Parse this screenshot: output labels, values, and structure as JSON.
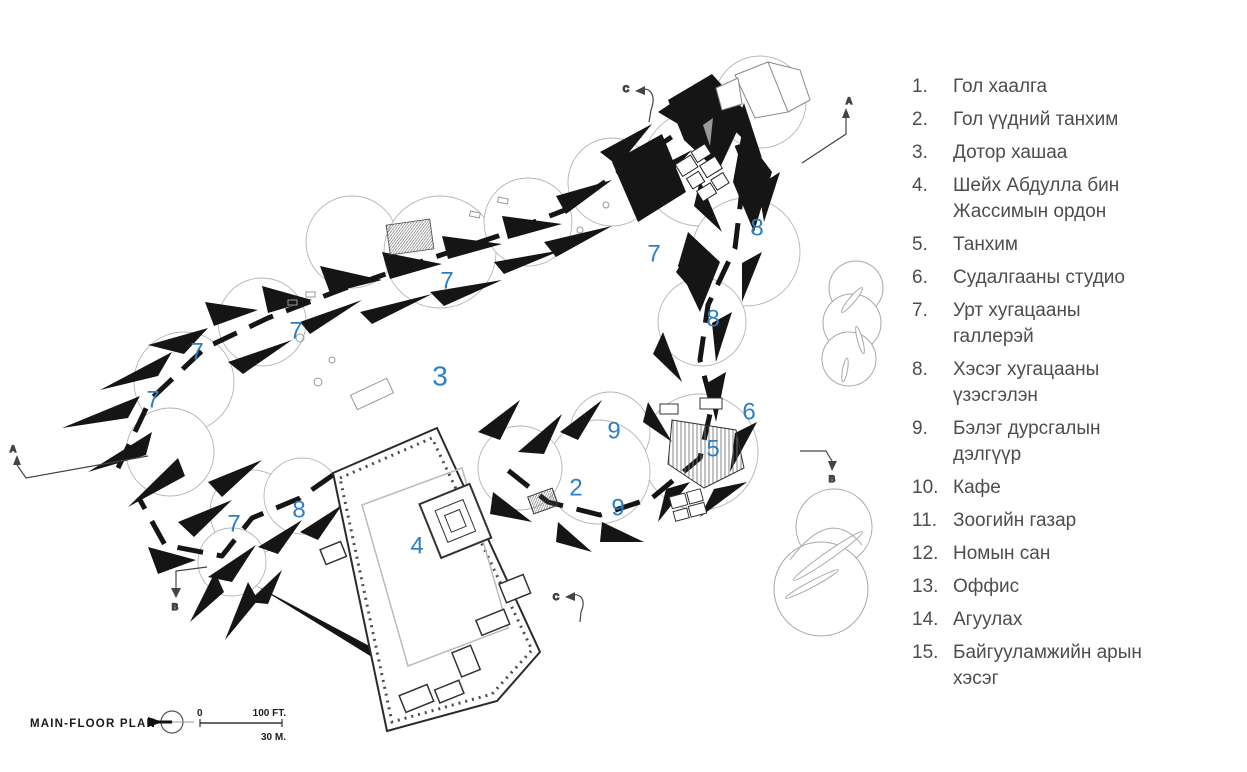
{
  "colors": {
    "number_blue": "#2e7fc2",
    "legend_text": "#4d4d4d",
    "plan_ink": "#151515"
  },
  "plan": {
    "title": "MAIN-FLOOR PLAN",
    "scale_bar": {
      "zero": "0",
      "feet": "100 FT.",
      "meters": "30 M."
    },
    "north_icon": "compass-circle",
    "room_numbers": [
      {
        "label": "7",
        "x": 447,
        "y": 281
      },
      {
        "label": "8",
        "x": 757,
        "y": 228
      },
      {
        "label": "7",
        "x": 654,
        "y": 254
      },
      {
        "label": "8",
        "x": 713,
        "y": 319
      },
      {
        "label": "7",
        "x": 296,
        "y": 331
      },
      {
        "label": "7",
        "x": 197,
        "y": 352
      },
      {
        "label": "3",
        "x": 440,
        "y": 376
      },
      {
        "label": "7",
        "x": 153,
        "y": 400
      },
      {
        "label": "6",
        "x": 749,
        "y": 412
      },
      {
        "label": "5",
        "x": 713,
        "y": 449
      },
      {
        "label": "9",
        "x": 614,
        "y": 431
      },
      {
        "label": "2",
        "x": 576,
        "y": 488
      },
      {
        "label": "9",
        "x": 618,
        "y": 508
      },
      {
        "label": "8",
        "x": 299,
        "y": 510
      },
      {
        "label": "7",
        "x": 234,
        "y": 524
      },
      {
        "label": "4",
        "x": 417,
        "y": 546
      }
    ],
    "section_markers": [
      {
        "label": "C",
        "x": 626,
        "y": 92
      },
      {
        "label": "A",
        "x": 849,
        "y": 104
      },
      {
        "label": "A",
        "x": 13,
        "y": 452
      },
      {
        "label": "B",
        "x": 832,
        "y": 482
      },
      {
        "label": "B",
        "x": 175,
        "y": 610
      },
      {
        "label": "C",
        "x": 556,
        "y": 600
      }
    ]
  },
  "legend": {
    "items": [
      {
        "num": "1.",
        "text": "Гол хаалга"
      },
      {
        "num": "2.",
        "text": "Гол үүдний танхим"
      },
      {
        "num": "3.",
        "text": "Дотор хашаа"
      },
      {
        "num": "4.",
        "text": "Шейх Абдулла бин Жассимын ордон"
      },
      {
        "num": "5.",
        "text": "Танхим"
      },
      {
        "num": "6.",
        "text": "Судалгааны студио"
      },
      {
        "num": "7.",
        "text": "Урт хугацааны галлерэй"
      },
      {
        "num": "8.",
        "text": "Хэсэг хугацааны үзэсгэлэн"
      },
      {
        "num": "9.",
        "text": "Бэлэг дурсгалын дэлгүүр"
      },
      {
        "num": "10.",
        "text": "Кафе"
      },
      {
        "num": "11.",
        "text": "Зоогийн газар"
      },
      {
        "num": "12.",
        "text": "Номын сан"
      },
      {
        "num": "13.",
        "text": "Оффис"
      },
      {
        "num": "14.",
        "text": "Агуулах"
      },
      {
        "num": "15.",
        "text": "Байгууламжийн арын хэсэг"
      }
    ]
  }
}
